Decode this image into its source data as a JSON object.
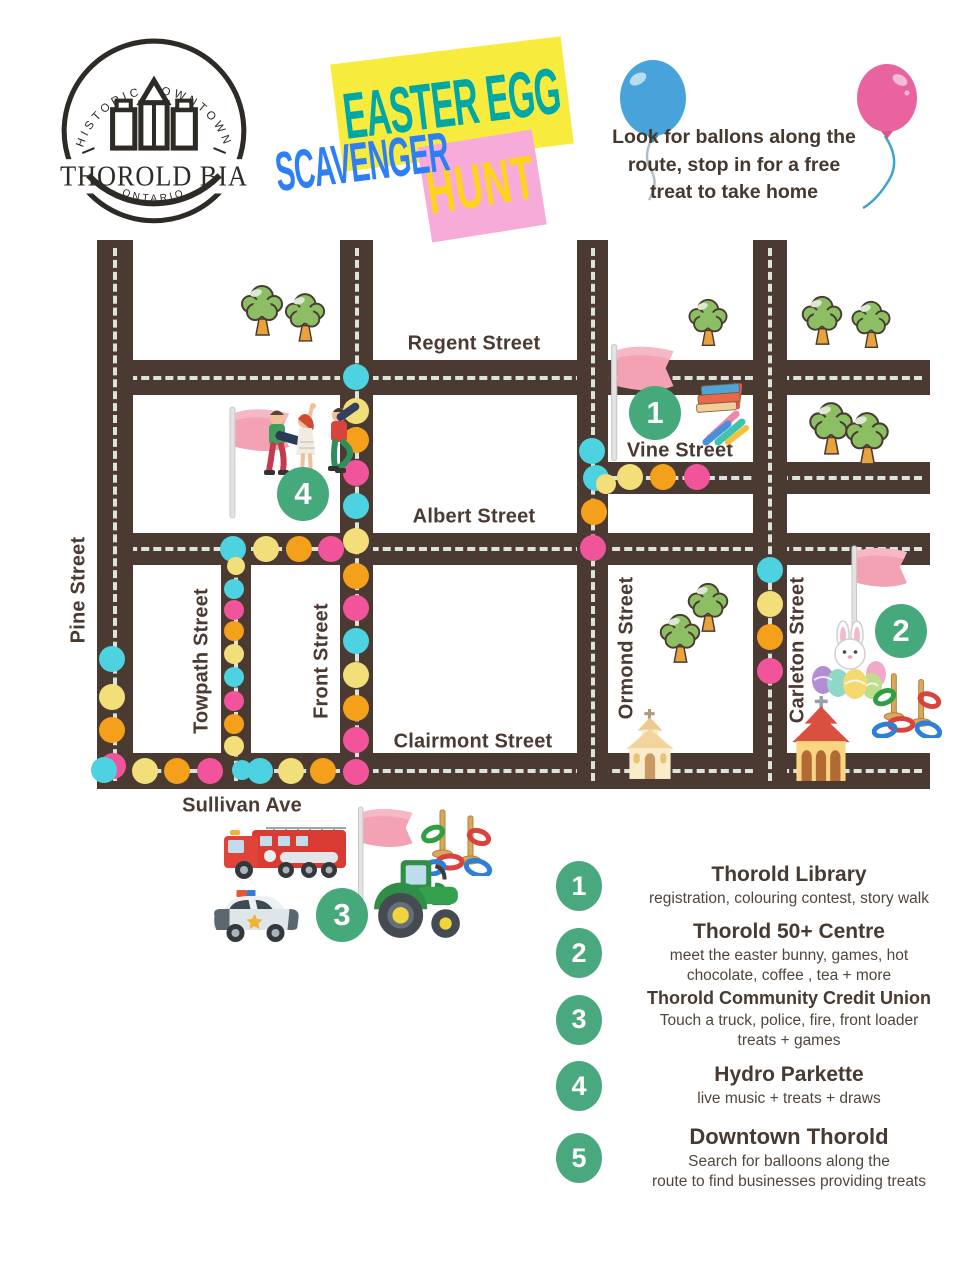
{
  "logo": {
    "arc_top": "HISTORIC DOWNTOWN",
    "name": "THOROLD BIA",
    "region": "ONTARIO"
  },
  "title": {
    "word1": "EASTER EGG",
    "word2": "SCAVENGER",
    "word3": "HUNT",
    "colors": {
      "word1_text": "#00a7a7",
      "word1_bg": "#f7ec3e",
      "word2_text": "#2e7ef7",
      "word3_text": "#ffd21c",
      "word3_bg": "#f7abd9"
    }
  },
  "note_lines": [
    "Look for ballons along the",
    "route, stop in for a free",
    "treat to take home"
  ],
  "map": {
    "colors": {
      "road": "#4a3a31",
      "dash": "#dbe4da",
      "marker_green": "#45a97c"
    },
    "dot_colors": {
      "C": "#4dd2e1",
      "Y": "#f3df7a",
      "O": "#f4a01b",
      "P": "#f2549b"
    },
    "roads": [
      {
        "id": "regent-street",
        "dir": "h",
        "x": 97,
        "y": 360,
        "len": 833,
        "th": 35
      },
      {
        "id": "vine-street-row",
        "dir": "h",
        "x": 577,
        "y": 462,
        "len": 353,
        "th": 32
      },
      {
        "id": "albert-street",
        "dir": "h",
        "x": 97,
        "y": 533,
        "len": 833,
        "th": 32
      },
      {
        "id": "clairmont-sullivan",
        "dir": "h",
        "x": 97,
        "y": 753,
        "len": 833,
        "th": 36
      },
      {
        "id": "pine-street",
        "dir": "v",
        "x": 97,
        "y": 240,
        "len": 549,
        "th": 36
      },
      {
        "id": "front-street",
        "dir": "v",
        "x": 340,
        "y": 240,
        "len": 549,
        "th": 33
      },
      {
        "id": "towpath-street",
        "dir": "v",
        "x": 221,
        "y": 533,
        "len": 256,
        "th": 30
      },
      {
        "id": "ormond-street",
        "dir": "v",
        "x": 577,
        "y": 240,
        "len": 549,
        "th": 31
      },
      {
        "id": "carleton-street",
        "dir": "v",
        "x": 753,
        "y": 240,
        "len": 549,
        "th": 34
      }
    ],
    "labels": [
      {
        "text": "Regent Street",
        "x": 474,
        "y": 344,
        "v": false
      },
      {
        "text": "Vine Street",
        "x": 680,
        "y": 451,
        "v": false
      },
      {
        "text": "Albert Street",
        "x": 474,
        "y": 517,
        "v": false
      },
      {
        "text": "Clairmont Street",
        "x": 473,
        "y": 742,
        "v": false
      },
      {
        "text": "Sullivan Ave",
        "x": 242,
        "y": 806,
        "v": false
      },
      {
        "text": "Pine Street",
        "x": 79,
        "y": 590,
        "v": true
      },
      {
        "text": "Towpath Street",
        "x": 202,
        "y": 661,
        "v": true
      },
      {
        "text": "Front Street",
        "x": 322,
        "y": 661,
        "v": true
      },
      {
        "text": "Ormond Street",
        "x": 627,
        "y": 648,
        "v": true
      },
      {
        "text": "Carleton Street",
        "x": 798,
        "y": 650,
        "v": true
      }
    ],
    "markers": [
      {
        "n": "1",
        "x": 655,
        "y": 413
      },
      {
        "n": "2",
        "x": 901,
        "y": 631
      },
      {
        "n": "3",
        "x": 342,
        "y": 915
      },
      {
        "n": "4",
        "x": 303,
        "y": 494
      }
    ],
    "dots": [
      {
        "x": 356,
        "y": 377,
        "c": "C"
      },
      {
        "x": 356,
        "y": 411,
        "c": "Y"
      },
      {
        "x": 356,
        "y": 440,
        "c": "O"
      },
      {
        "x": 356,
        "y": 473,
        "c": "P"
      },
      {
        "x": 356,
        "y": 506,
        "c": "C"
      },
      {
        "x": 356,
        "y": 541,
        "c": "Y"
      },
      {
        "x": 356,
        "y": 576,
        "c": "O"
      },
      {
        "x": 356,
        "y": 608,
        "c": "P"
      },
      {
        "x": 356,
        "y": 641,
        "c": "C"
      },
      {
        "x": 356,
        "y": 675,
        "c": "Y"
      },
      {
        "x": 356,
        "y": 708,
        "c": "O"
      },
      {
        "x": 356,
        "y": 740,
        "c": "P"
      },
      {
        "x": 356,
        "y": 772,
        "c": "P"
      },
      {
        "x": 233,
        "y": 549,
        "c": "C"
      },
      {
        "x": 236,
        "y": 566,
        "c": "Y",
        "r": 9
      },
      {
        "x": 234,
        "y": 589,
        "c": "C",
        "r": 10
      },
      {
        "x": 234,
        "y": 610,
        "c": "P",
        "r": 10
      },
      {
        "x": 234,
        "y": 631,
        "c": "O",
        "r": 10
      },
      {
        "x": 234,
        "y": 654,
        "c": "Y",
        "r": 10
      },
      {
        "x": 234,
        "y": 677,
        "c": "C",
        "r": 10
      },
      {
        "x": 234,
        "y": 701,
        "c": "P",
        "r": 10
      },
      {
        "x": 234,
        "y": 724,
        "c": "O",
        "r": 10
      },
      {
        "x": 234,
        "y": 746,
        "c": "Y",
        "r": 10
      },
      {
        "x": 242,
        "y": 770,
        "c": "C",
        "r": 10
      },
      {
        "x": 266,
        "y": 549,
        "c": "Y"
      },
      {
        "x": 299,
        "y": 549,
        "c": "O"
      },
      {
        "x": 331,
        "y": 549,
        "c": "P"
      },
      {
        "x": 593,
        "y": 548,
        "c": "P"
      },
      {
        "x": 112,
        "y": 659,
        "c": "C"
      },
      {
        "x": 112,
        "y": 697,
        "c": "Y"
      },
      {
        "x": 112,
        "y": 730,
        "c": "O"
      },
      {
        "x": 113,
        "y": 766,
        "c": "P"
      },
      {
        "x": 104,
        "y": 770,
        "c": "C"
      },
      {
        "x": 145,
        "y": 771,
        "c": "Y"
      },
      {
        "x": 177,
        "y": 771,
        "c": "O"
      },
      {
        "x": 210,
        "y": 771,
        "c": "P"
      },
      {
        "x": 260,
        "y": 771,
        "c": "C"
      },
      {
        "x": 291,
        "y": 771,
        "c": "Y"
      },
      {
        "x": 323,
        "y": 771,
        "c": "O"
      },
      {
        "x": 592,
        "y": 451,
        "c": "C"
      },
      {
        "x": 596,
        "y": 478,
        "c": "C"
      },
      {
        "x": 606,
        "y": 484,
        "c": "Y",
        "r": 10
      },
      {
        "x": 630,
        "y": 477,
        "c": "Y"
      },
      {
        "x": 663,
        "y": 477,
        "c": "O"
      },
      {
        "x": 697,
        "y": 477,
        "c": "P"
      },
      {
        "x": 594,
        "y": 512,
        "c": "O"
      },
      {
        "x": 770,
        "y": 570,
        "c": "C"
      },
      {
        "x": 770,
        "y": 604,
        "c": "Y"
      },
      {
        "x": 770,
        "y": 637,
        "c": "O"
      },
      {
        "x": 770,
        "y": 671,
        "c": "P"
      }
    ],
    "icons": [
      {
        "t": "tree",
        "x": 240,
        "y": 283,
        "w": 44,
        "h": 56
      },
      {
        "t": "tree",
        "x": 284,
        "y": 291,
        "w": 42,
        "h": 54
      },
      {
        "t": "tree",
        "x": 686,
        "y": 297,
        "w": 44,
        "h": 52
      },
      {
        "t": "tree",
        "x": 800,
        "y": 294,
        "w": 44,
        "h": 54
      },
      {
        "t": "tree",
        "x": 850,
        "y": 299,
        "w": 42,
        "h": 52
      },
      {
        "t": "tree",
        "x": 808,
        "y": 400,
        "w": 46,
        "h": 58
      },
      {
        "t": "tree",
        "x": 844,
        "y": 410,
        "w": 46,
        "h": 58
      },
      {
        "t": "tree",
        "x": 686,
        "y": 581,
        "w": 44,
        "h": 54
      },
      {
        "t": "tree",
        "x": 658,
        "y": 612,
        "w": 44,
        "h": 54
      },
      {
        "t": "flag",
        "x": 224,
        "y": 404,
        "w": 70,
        "h": 118
      },
      {
        "t": "flag",
        "x": 606,
        "y": 336,
        "w": 72,
        "h": 134
      },
      {
        "t": "flag",
        "x": 846,
        "y": 543,
        "w": 66,
        "h": 110
      },
      {
        "t": "flag",
        "x": 352,
        "y": 804,
        "w": 66,
        "h": 108
      },
      {
        "t": "church_beige",
        "x": 616,
        "y": 708,
        "w": 68,
        "h": 72
      },
      {
        "t": "church_red",
        "x": 784,
        "y": 696,
        "w": 74,
        "h": 86
      },
      {
        "t": "bunny_eggs",
        "x": 810,
        "y": 620,
        "w": 80,
        "h": 82
      },
      {
        "t": "ring_toss",
        "x": 872,
        "y": 668,
        "w": 70,
        "h": 70
      },
      {
        "t": "ring_toss",
        "x": 420,
        "y": 804,
        "w": 72,
        "h": 72
      },
      {
        "t": "fire_truck",
        "x": 220,
        "y": 822,
        "w": 132,
        "h": 60
      },
      {
        "t": "police_car",
        "x": 208,
        "y": 884,
        "w": 96,
        "h": 62
      },
      {
        "t": "tractor",
        "x": 372,
        "y": 856,
        "w": 92,
        "h": 88
      },
      {
        "t": "musicians",
        "x": 246,
        "y": 402,
        "w": 122,
        "h": 100
      },
      {
        "t": "books_crayons",
        "x": 680,
        "y": 382,
        "w": 76,
        "h": 64
      }
    ]
  },
  "legend": {
    "items": [
      {
        "num": "1",
        "title": "Thorold Library",
        "lines": [
          "registration, colouring contest, story walk"
        ],
        "y": 858,
        "ts": 21
      },
      {
        "num": "2",
        "title": "Thorold 50+ Centre",
        "lines": [
          "meet the easter bunny, games, hot",
          "chocolate, coffee , tea + more"
        ],
        "y": 920,
        "ts": 21
      },
      {
        "num": "3",
        "title": "Thorold Community Credit Union",
        "lines": [
          "Touch a truck, police, fire, front loader",
          "treats + games"
        ],
        "y": 988,
        "ts": 18
      },
      {
        "num": "4",
        "title": "Hydro Parkette",
        "lines": [
          "live music + treats + draws"
        ],
        "y": 1058,
        "ts": 21
      },
      {
        "num": "5",
        "title": "Downtown Thorold",
        "lines": [
          "Search for balloons along the",
          "route to find  businesses providing treats"
        ],
        "y": 1124,
        "ts": 22
      }
    ]
  }
}
